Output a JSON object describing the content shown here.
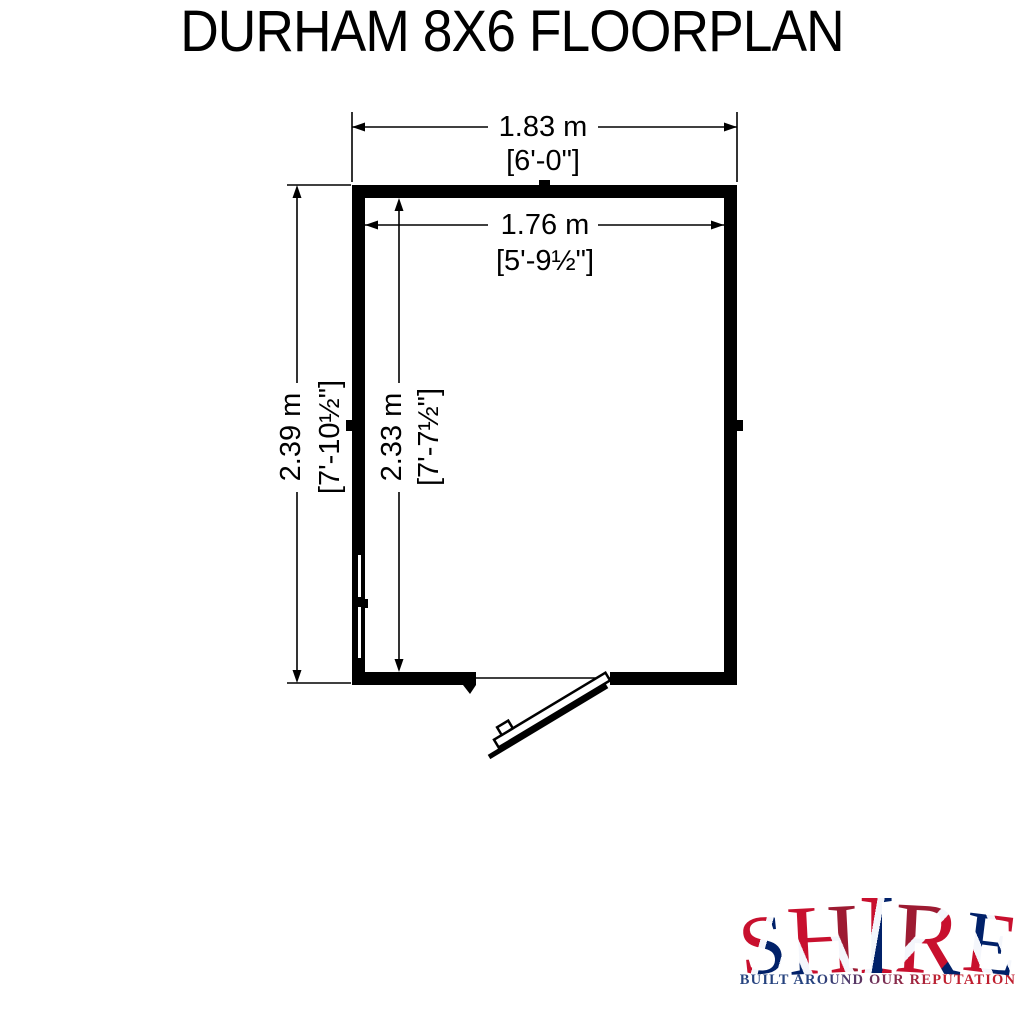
{
  "page": {
    "background": "#ffffff",
    "line_color": "#000000"
  },
  "floorplan": {
    "width_outer_metric": "1.83 m",
    "width_outer_imperial": "[6'-0\"]",
    "width_inner_metric": "1.76 m",
    "width_inner_imperial": "[5'-9½\"]",
    "height_outer_metric": "2.39 m",
    "height_outer_imperial": "[7'-10½\"]",
    "height_inner_metric": "2.33 m",
    "height_inner_imperial": "[7'-7½\"]"
  },
  "title": "DURHAM 8X6 FLOORPLAN",
  "logo": {
    "letters": [
      "S",
      "H",
      "I",
      "R",
      "E"
    ],
    "tagline": "BUILT AROUND OUR REPUTATION",
    "colors": {
      "flag_red": "#C8102E",
      "flag_dark_red": "#9D1B32",
      "flag_blue": "#012169",
      "flag_white": "#F4F6FB",
      "tagline_blue": "#26437F",
      "tagline_red": "#BF1E2E"
    }
  }
}
